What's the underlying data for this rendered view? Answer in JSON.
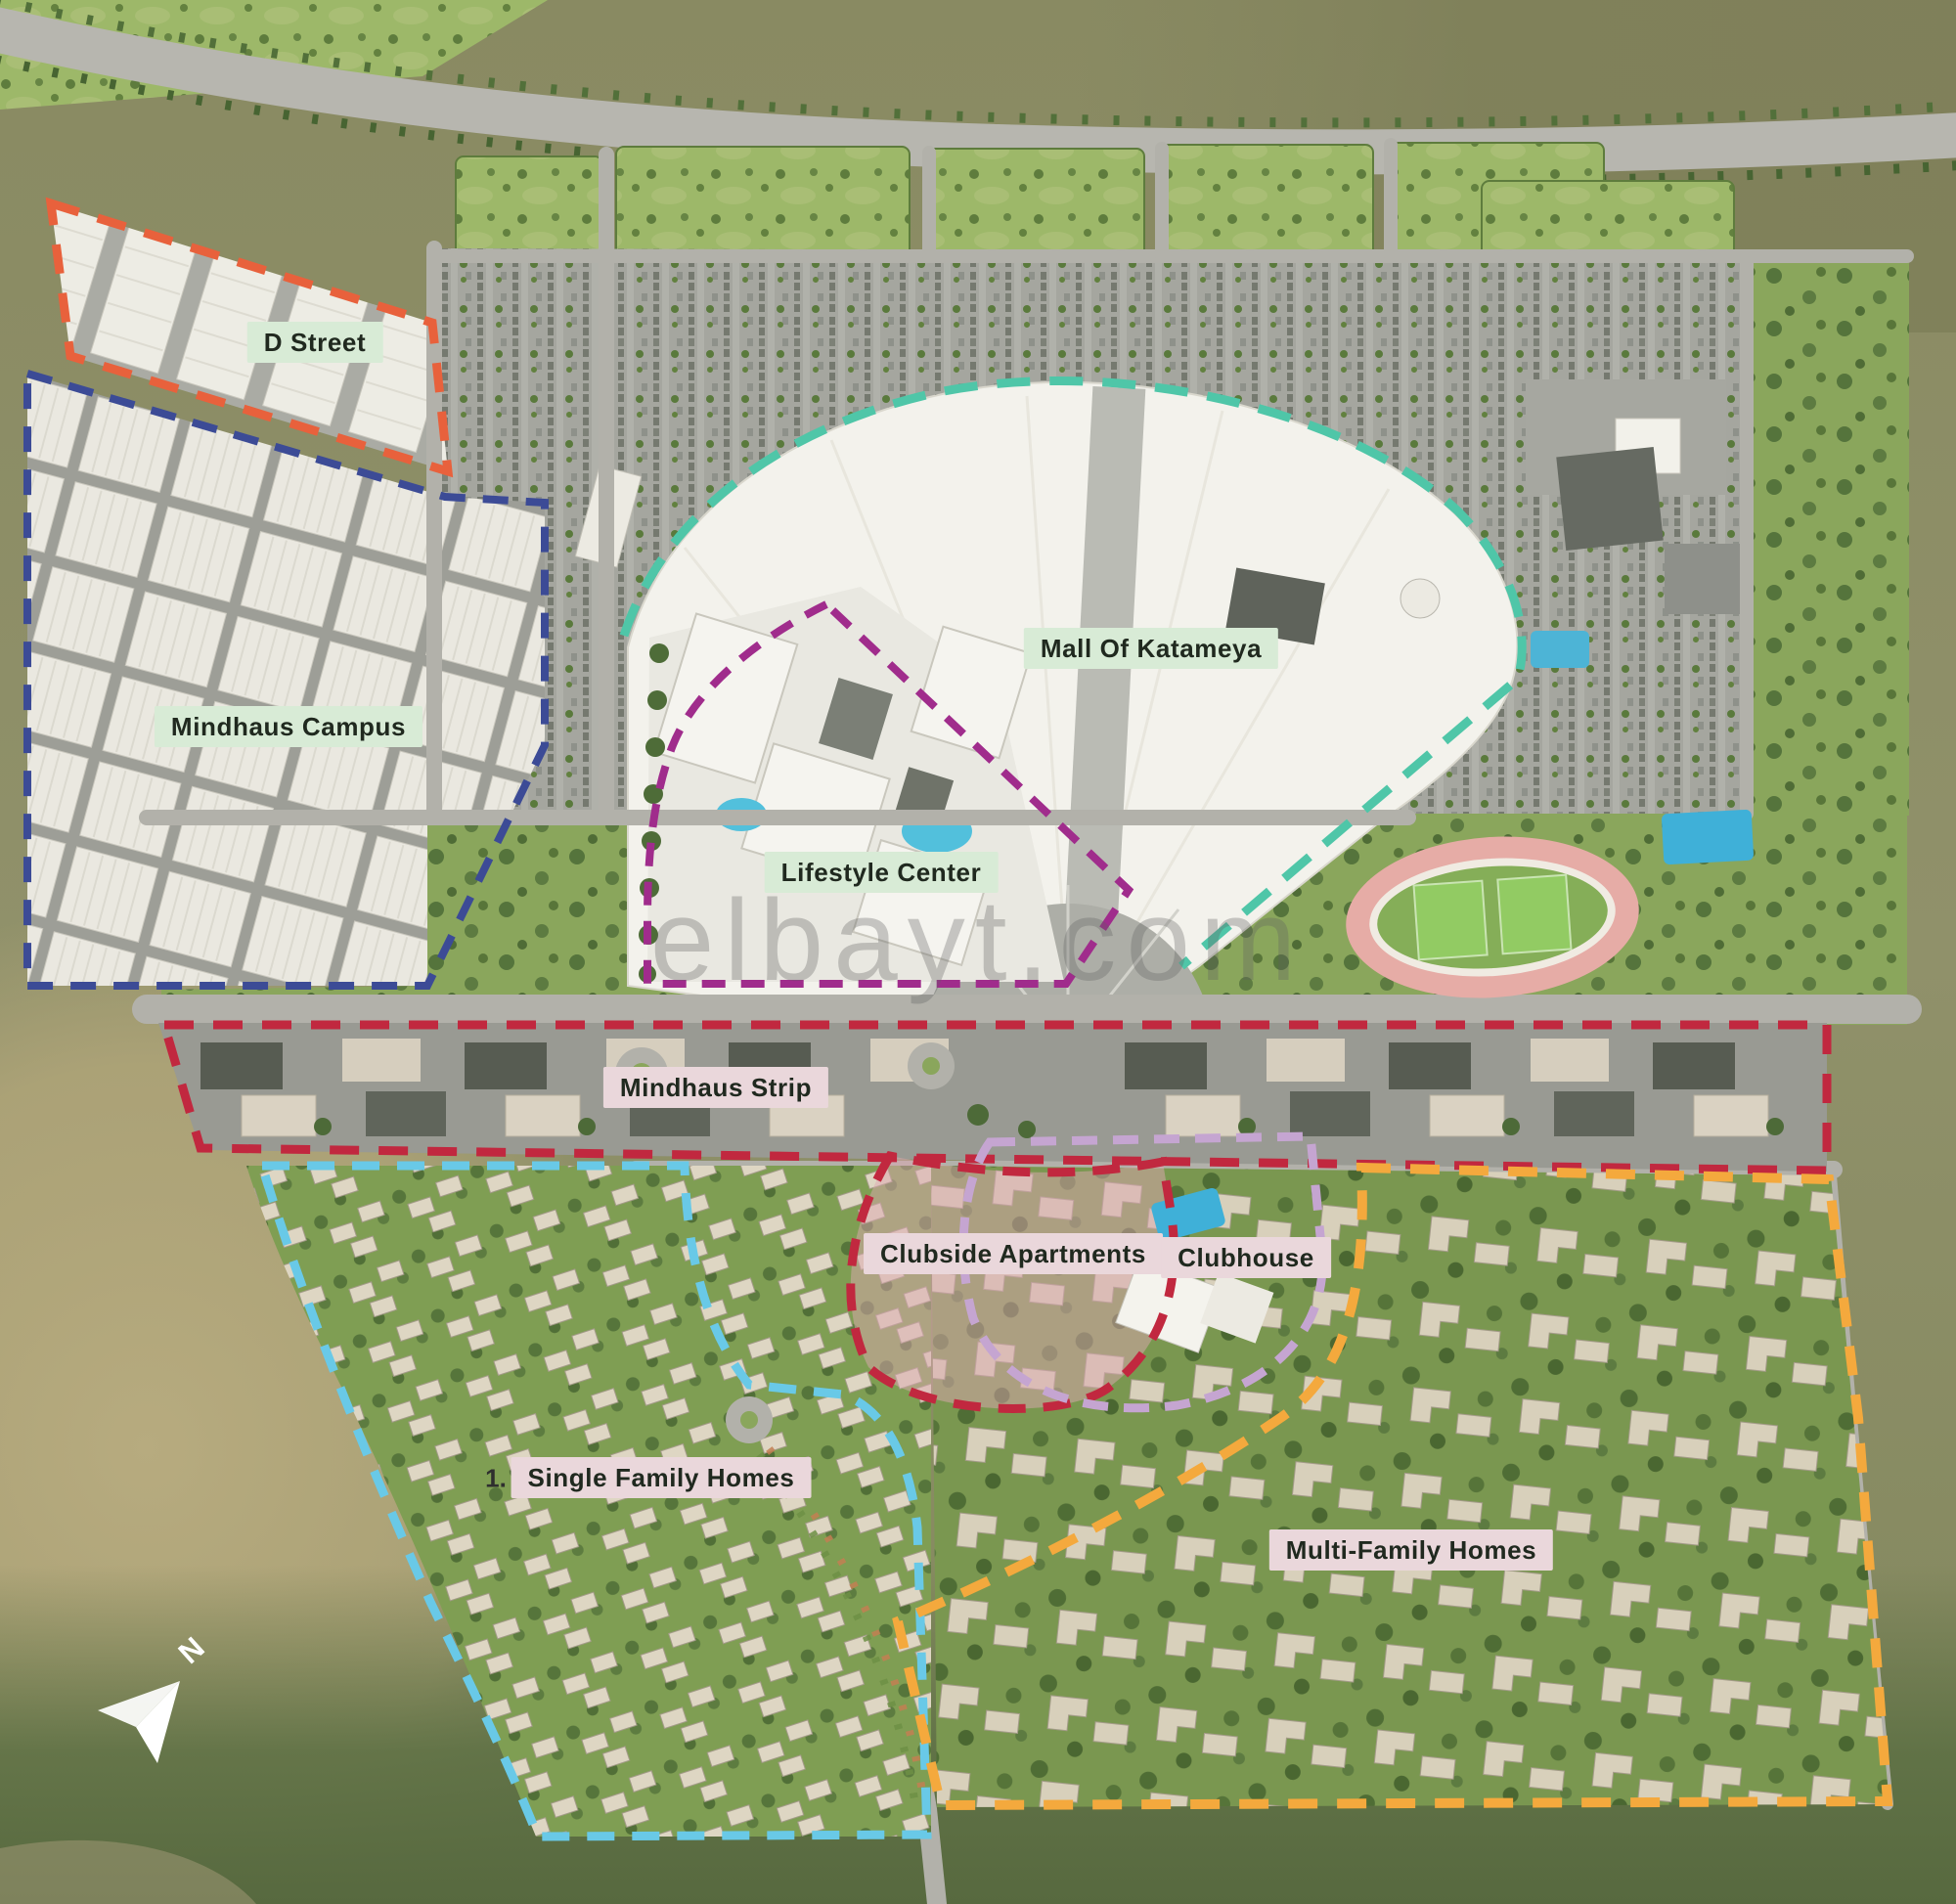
{
  "map": {
    "watermark": "elbayt.com",
    "compass_label": "N",
    "note": "1.",
    "chip_colors": {
      "green": "#d8ebd6",
      "pink": "#ead7db"
    },
    "chip_text_color": "#20291f",
    "zones": [
      {
        "id": "d-street",
        "label": "D Street",
        "chip": "green",
        "outline_color": "#e8613c"
      },
      {
        "id": "mindhaus-campus",
        "label": "Mindhaus Campus",
        "chip": "green",
        "outline_color": "#3c4b96"
      },
      {
        "id": "mall-of-katameya",
        "label": "Mall Of Katameya",
        "chip": "green",
        "outline_color": "#4fc6a8"
      },
      {
        "id": "lifestyle-center",
        "label": "Lifestyle Center",
        "chip": "green",
        "outline_color": "#a02c8c"
      },
      {
        "id": "mindhaus-strip",
        "label": "Mindhaus Strip",
        "chip": "pink",
        "outline_color": "#c1283f"
      },
      {
        "id": "clubside-apartments",
        "label": "Clubside Apartments",
        "chip": "pink",
        "outline_color": "#c1283f"
      },
      {
        "id": "clubhouse",
        "label": "Clubhouse",
        "chip": "pink",
        "outline_color": "#c5a5d1"
      },
      {
        "id": "single-family-homes",
        "label": "Single Family Homes",
        "chip": "pink",
        "outline_color": "#69c9e7"
      },
      {
        "id": "multi-family-homes",
        "label": "Multi-Family Homes",
        "chip": "pink",
        "outline_color": "#f4a93d"
      }
    ],
    "terrain_colors": {
      "desert": "#8b8c64",
      "desert_dark": "#5c6f45",
      "sand": "#b6aa7e",
      "paving": "#a5a69f",
      "lawn": "#9db869",
      "mall_roof": "#f3f2ec",
      "track_pink": "#e6aca6",
      "pool": "#52c0dc"
    }
  }
}
